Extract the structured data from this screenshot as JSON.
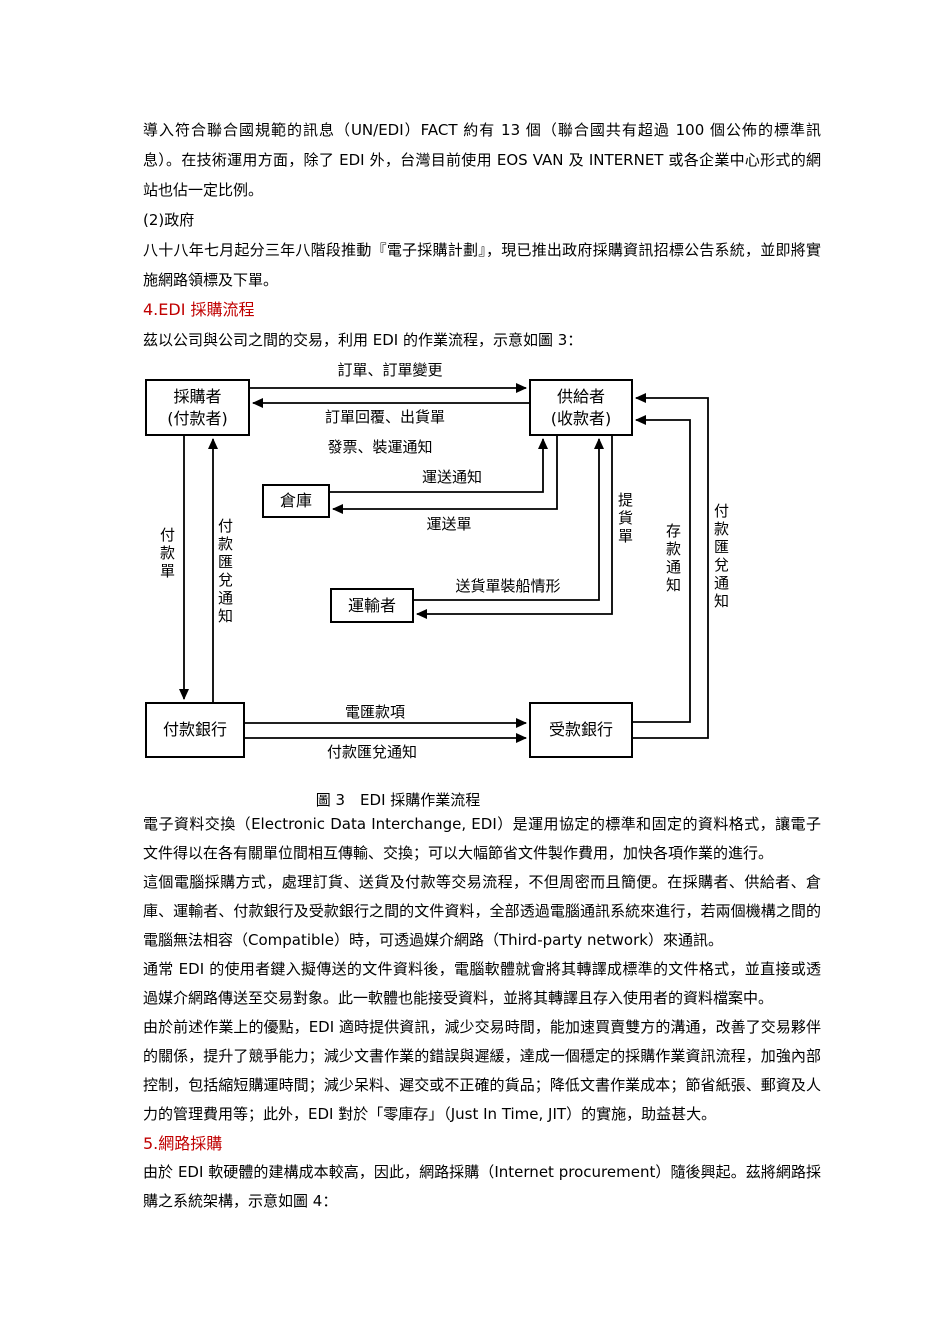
{
  "colors": {
    "heading_red": "#c00000",
    "text": "#000000",
    "diagram_line": "#000000"
  },
  "document": {
    "top": {
      "p1": "導入符合聯合國規範的訊息（UN/EDI）FACT 約有 13 個（聯合國共有超過 100 個公佈的標準訊息）。在技術運用方面，除了 EDI 外，台灣目前使用 EOS VAN 及 INTERNET 或各企業中心形式的網站也佔一定比例。",
      "p2": "(2)政府",
      "p3": "八十八年七月起分三年八階段推動『電子採購計劃』，現已推出政府採購資訊招標公告系統，並即將實施網路領標及下單。",
      "heading4": "4.EDI 採購流程",
      "p4": "茲以公司與公司之間的交易，利用 EDI 的作業流程，示意如圖 3："
    },
    "figure3": {
      "caption": "圖 3　EDI 採購作業流程",
      "nodes": {
        "buyer_line1": "採購者",
        "buyer_line2": "(付款者)",
        "supplier_line1": "供給者",
        "supplier_line2": "(收款者)",
        "warehouse": "倉庫",
        "transporter": "運輸者",
        "paying_bank": "付款銀行",
        "receiving_bank": "受款銀行"
      },
      "flows": {
        "order": "訂單、訂單變更",
        "order_reply": "訂單回覆、出貨單",
        "invoice_shipping": "發票、裝運通知",
        "transport_notice": "運送通知",
        "transport_order": "運送單",
        "delivery_shipping_status": "送貨單裝船情形",
        "pickup_order": "提貨單",
        "payment_order": "付款單",
        "payment_remittance_left": "付款匯兌通知",
        "wire_transfer": "電匯款項",
        "payment_remittance_bottom": "付款匯兌通知",
        "deposit_notice": "存款通知",
        "payment_remittance_right": "付款匯兌通知"
      }
    },
    "bottom": {
      "p5": "電子資料交換（Electronic Data Interchange, EDI）是運用協定的標準和固定的資料格式，讓電子文件得以在各有關單位間相互傳輸、交換；可以大幅節省文件製作費用，加快各項作業的進行。",
      "p6": "這個電腦採購方式，處理訂貨、送貨及付款等交易流程，不但周密而且簡便。在採購者、供給者、倉庫、運輸者、付款銀行及受款銀行之間的文件資料，全部透過電腦通訊系統來進行，若兩個機構之間的電腦無法相容（Compatible）時，可透過媒介網路（Third-party network）來通訊。",
      "p7": "通常 EDI 的使用者鍵入擬傳送的文件資料後，電腦軟體就會將其轉譯成標準的文件格式，並直接或透過媒介網路傳送至交易對象。此一軟體也能接受資料，並將其轉譯且存入使用者的資料檔案中。",
      "p8": "由於前述作業上的優點，EDI 適時提供資訊，減少交易時間，能加速買賣雙方的溝通，改善了交易夥伴的關係，提升了競爭能力；減少文書作業的錯誤與遲緩，達成一個穩定的採購作業資訊流程，加強內部控制，包括縮短購運時間；減少呆料、遲交或不正確的貨品；降低文書作業成本；節省紙張、郵資及人力的管理費用等；此外，EDI 對於「零庫存」（Just In Time, JIT）的實施，助益甚大。",
      "heading5": "5.網路採購",
      "p9": "由於 EDI 軟硬體的建構成本較高，因此，網路採購（Internet procurement）隨後興起。茲將網路採購之系統架構，示意如圖 4："
    }
  }
}
